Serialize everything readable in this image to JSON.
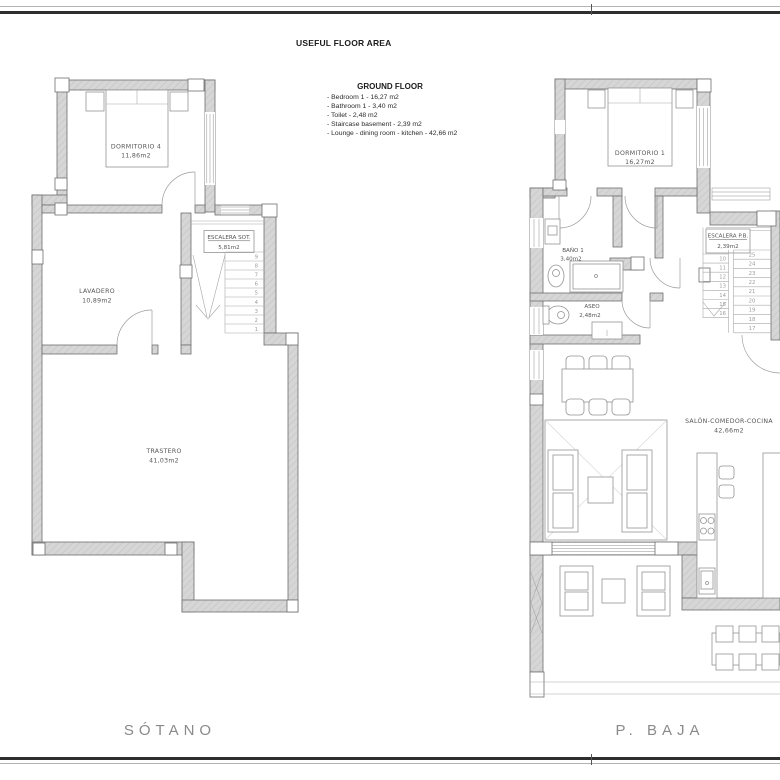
{
  "header": {
    "title": "USEFUL FLOOR AREA",
    "legend_title": "GROUND FLOOR",
    "legend_items": [
      "- Bedroom 1 - 16,27 m2",
      "- Bathroom 1 - 3,40 m2",
      "- Toilet - 2,48 m2",
      "- Staircase basement - 2,39 m2",
      "- Lounge - dining room - kitchen - 42,66 m2"
    ]
  },
  "plans": {
    "sotano": {
      "caption": "SÓTANO",
      "rooms": {
        "dormitorio4": {
          "name": "DORMITORIO 4",
          "area": "11,86m2"
        },
        "lavadero": {
          "name": "LAVADERO",
          "area": "10,89m2"
        },
        "escalera": {
          "name": "ESCALERA SOT.",
          "area": "5,81m2"
        },
        "trastero": {
          "name": "TRASTERO",
          "area": "41,03m2"
        }
      },
      "stair_numbers": [
        "9",
        "8",
        "7",
        "6",
        "5",
        "4",
        "3",
        "2",
        "1"
      ]
    },
    "pbaja": {
      "caption": "P. BAJA",
      "rooms": {
        "dormitorio1": {
          "name": "DORMITORIO 1",
          "area": "16,27m2"
        },
        "bano1": {
          "name": "BAÑO 1",
          "area": "3,40m2"
        },
        "aseo": {
          "name": "ASEO",
          "area": "2,48m2"
        },
        "escalera": {
          "name": "ESCALERA P.B.",
          "area": "2,39m2"
        },
        "salon": {
          "name": "SALÓN-COMEDOR-COCINA",
          "area": "42,66m2"
        }
      },
      "stair_numbers_left": [
        "10",
        "11",
        "12",
        "13",
        "14",
        "15",
        "16"
      ],
      "stair_numbers_right": [
        "25",
        "24",
        "23",
        "22",
        "21",
        "20",
        "19",
        "18",
        "17"
      ]
    }
  },
  "colors": {
    "wall_fill": "#d6d6d6",
    "wall_stroke": "#6f6f6f",
    "line": "#9a9a9a",
    "label_text": "#555555",
    "caption_text": "#8a8a8a"
  }
}
